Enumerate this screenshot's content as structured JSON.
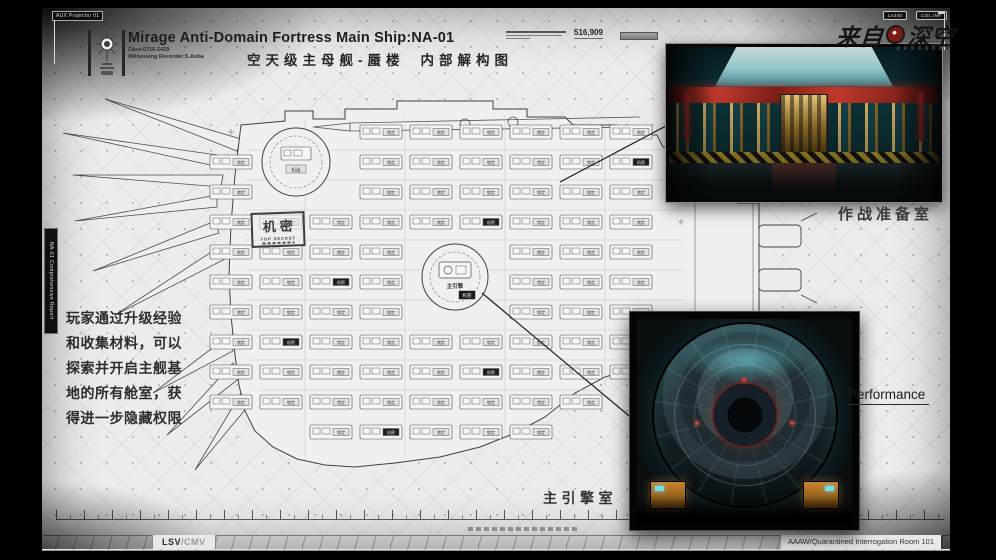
{
  "header": {
    "aux_tag": "AUX Projector 01",
    "title": "Mirage Anti-Domain Fortress Main Ship:NA-01",
    "case_no": "Case:0716-1429",
    "recorder": "Witnessing Recorder:S.Aoba",
    "subtitle_1": "空天级主母舰-蜃楼",
    "subtitle_2": "内部解构图",
    "serial": "516,909"
  },
  "brand": {
    "badge_1": "Lv340",
    "badge_2": "COL.INF",
    "name_left": "来自",
    "name_right": "深空"
  },
  "side_strip": {
    "text": "NA-01 Comprehensive Report"
  },
  "notes": {
    "lines": [
      "玩家通过升级经验",
      "和收集材料，可以",
      "探索并开启主舰基",
      "地的所有舱室，获",
      "得进一步隐藏权限"
    ]
  },
  "stamp": {
    "cn": "机密",
    "en": "TOP SECRET"
  },
  "labels": {
    "war_room": "作战准备室",
    "performance": "Performance",
    "main_engine_room": "主引擎室"
  },
  "blueprint": {
    "main_engine_label": "主引擎",
    "fore_label": "机组",
    "module_label": "锁定",
    "secret_tag": "机密"
  },
  "footer": {
    "left_a": "LSV",
    "left_b": "/CMV",
    "right": "AAAW/Quarantined Interrogation Room 101"
  }
}
